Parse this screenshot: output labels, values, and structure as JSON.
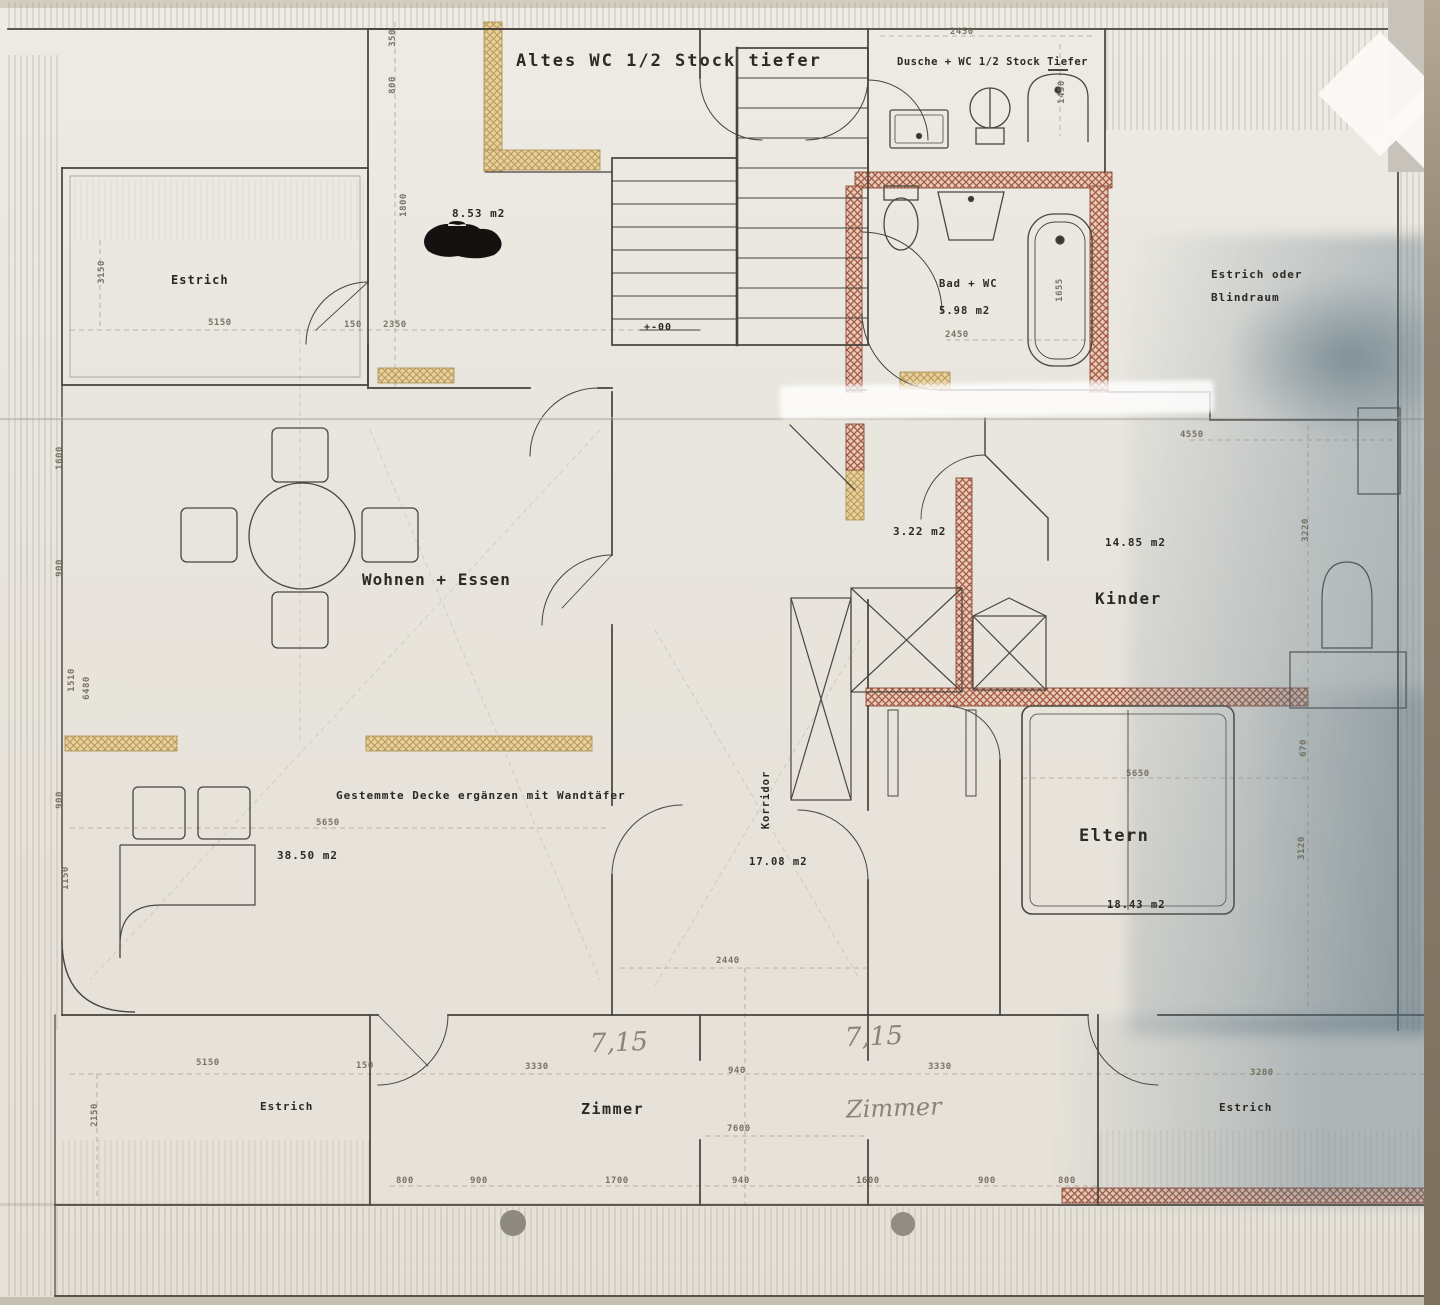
{
  "document": {
    "type": "floor-plan-scan",
    "description": "Photographed architectural floor plan of an attic storey with German labels"
  },
  "labels": {
    "altes_wc": "Altes WC 1/2 Stock tiefer",
    "dusche_wc": "Dusche + WC 1/2 Stock Tiefer",
    "kueche_area": "8.53 m2",
    "estrich_top_left": "Estrich",
    "bad_wc": "Bad + WC",
    "bad_wc_area": "5.98 m2",
    "estrich_oder": "Estrich oder",
    "blindraum": "Blindraum",
    "wohnen_essen": "Wohnen + Essen",
    "flur_area": "3.22 m2",
    "kinder": "Kinder",
    "kinder_area": "14.85 m2",
    "eltern": "Eltern",
    "eltern_area": "18.43 m2",
    "korridor": "Korridor",
    "korridor_area": "17.08 m2",
    "wohnen_area": "38.50 m2",
    "ceiling_note": "Gestemmte Decke ergänzen mit Wandtäfer",
    "zimmer_bottom": "Zimmer",
    "estrich_bottom_left": "Estrich",
    "estrich_bottom_right": "Estrich",
    "level_mark": "+-00"
  },
  "handwritten": {
    "dim_left": "7,15",
    "dim_right": "7,15",
    "zimmer": "Zimmer"
  },
  "dims": {
    "d2450_top": "2450",
    "d1450": "1450",
    "d350": "350",
    "d800_top": "800",
    "d1800": "1800",
    "d5150_tl": "5150",
    "d3150": "3150",
    "d150_tl": "150",
    "d2350": "2350",
    "d2450_bad": "2450",
    "d1655": "1655",
    "d1600": "1600",
    "d900_l1": "900",
    "d1510": "1510",
    "d6480": "6480",
    "d900_l2": "900",
    "d1150": "1150",
    "d4550": "4550",
    "d3220": "3220",
    "d670": "670",
    "d3120": "3120",
    "d5650_eltern": "5650",
    "d5650_wohnen": "5650",
    "d2440": "2440",
    "d940": "940",
    "d3330_l": "3330",
    "d3330_r": "3330",
    "d7600": "7600",
    "d5150_bl": "5150",
    "d150_bl": "150",
    "d2150": "2150",
    "d3200": "3200",
    "d800_b1": "800",
    "d900_b1": "900",
    "d1700": "1700",
    "d940_b": "940",
    "d1600_b": "1600",
    "d900_b2": "900",
    "d800_b2": "800"
  },
  "colors": {
    "paper": "#e8e5de",
    "line": "#46423b",
    "tan_wall": "#d8b271",
    "red_wall": "#b2624a",
    "redaction": "#141210",
    "photo_shadow_blue": "#5a7280"
  }
}
